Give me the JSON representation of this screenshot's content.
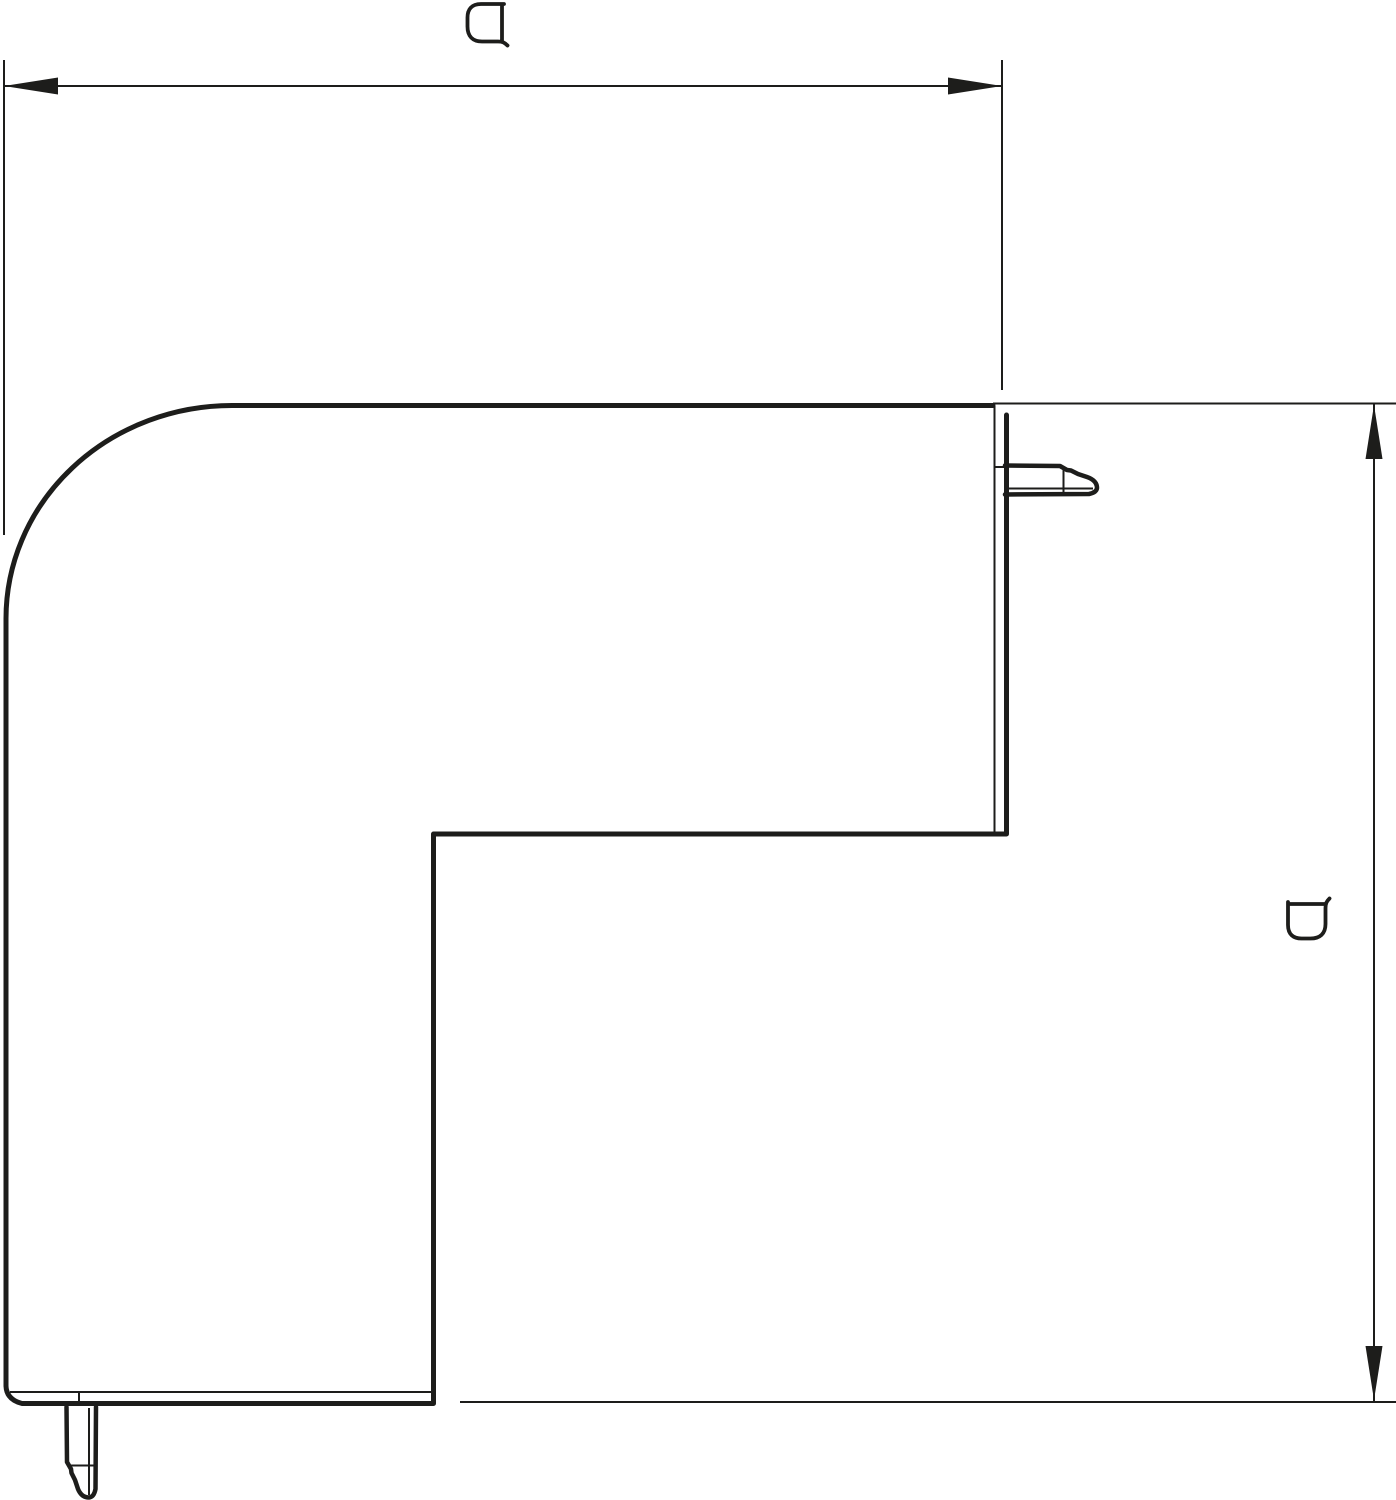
{
  "meta": {
    "canvas": {
      "width": 1396,
      "height": 1500
    },
    "colors": {
      "background": "#ffffff",
      "line": "#1d1d1b"
    }
  },
  "dimensions": {
    "width": {
      "label": "a",
      "orientation": "horizontal"
    },
    "height": {
      "label": "a",
      "orientation": "vertical"
    }
  }
}
